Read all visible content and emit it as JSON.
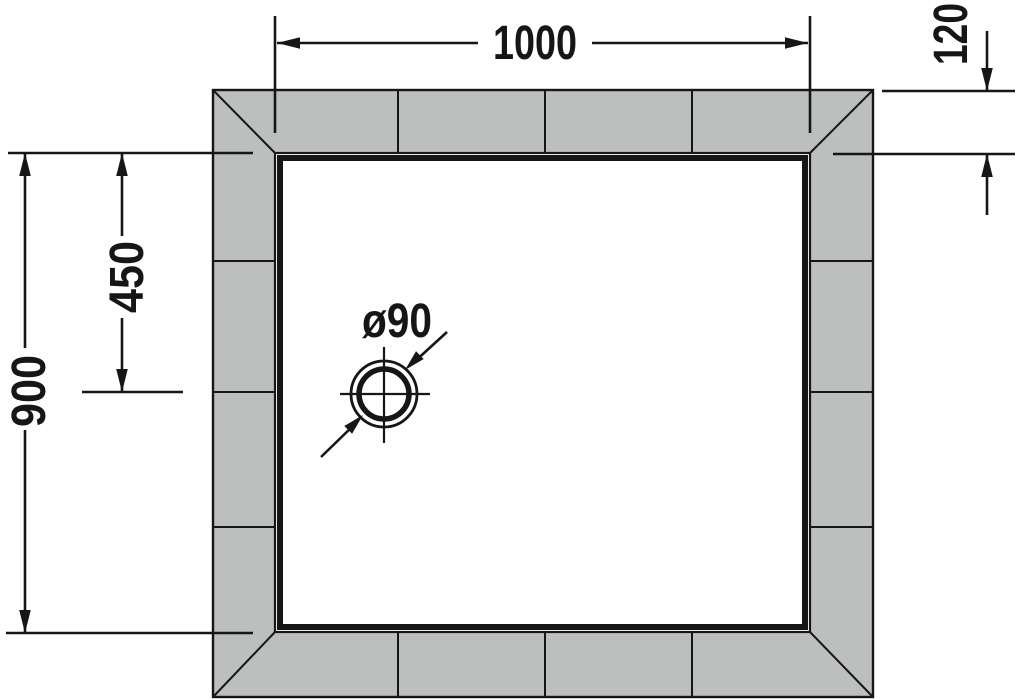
{
  "figure": {
    "type": "technical-drawing",
    "subject": "rectangular shower tray with tiled surround, plan view",
    "labels": {
      "width": "1000",
      "flange": "120",
      "drain_offset": "450",
      "depth": "900",
      "drain_diameter": "ø90"
    },
    "colors": {
      "line": "#161616",
      "tile": "#bdbfbf",
      "tray": "#ffffff",
      "background": "#ffffff"
    }
  }
}
